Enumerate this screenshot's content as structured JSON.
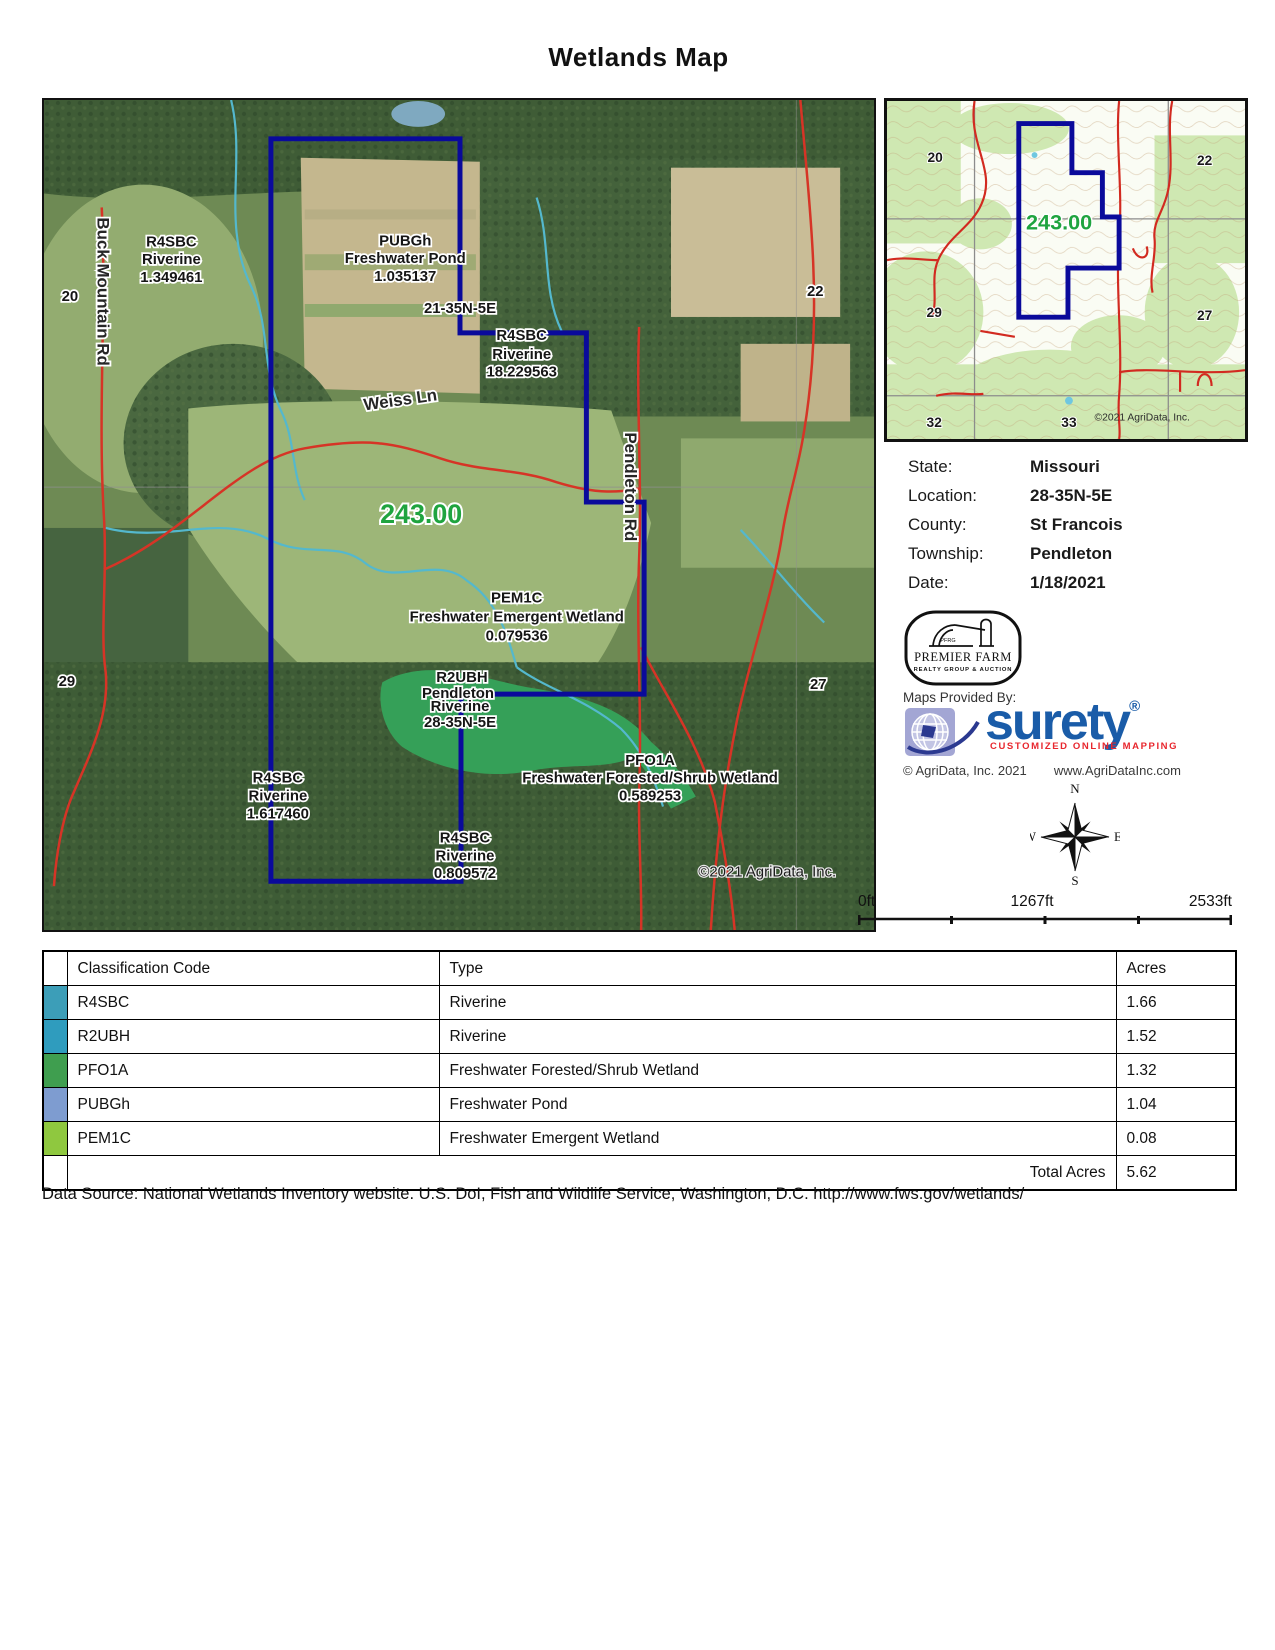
{
  "title": "Wetlands Map",
  "main_map": {
    "roads": {
      "buck_mountain": "Buck Mountain Rd",
      "weiss": "Weiss Ln",
      "pendleton": "Pendleton Rd"
    },
    "sections": {
      "s20": "20",
      "s21": "21-35N-5E",
      "s22": "22",
      "s29": "29",
      "s27": "27"
    },
    "parcel_acreage": "243.00",
    "wetlands": [
      {
        "code": "R4SBC",
        "type": "Riverine",
        "value": "1.349461"
      },
      {
        "code": "PUBGh",
        "type": "Freshwater Pond",
        "value": "1.035137"
      },
      {
        "code": "R4SBC",
        "type": "Riverine",
        "value": "18.229563"
      },
      {
        "code": "PEM1C",
        "type": "Freshwater Emergent Wetland",
        "value": "0.079536"
      },
      {
        "code": "PFO1A",
        "type": "Freshwater Forested/Shrub Wetland",
        "value": "0.589253"
      },
      {
        "code": "R4SBC",
        "type": "Riverine",
        "value": "1.617460"
      },
      {
        "code": "R4SBC",
        "type": "Riverine",
        "value": "0.809572"
      }
    ],
    "r2ubh_label": {
      "code": "R2UBH",
      "township": "Pendleton",
      "type": "Riverine",
      "section": "28-35N-5E"
    },
    "copyright": "©2021 AgriData, Inc."
  },
  "inset_map": {
    "sections": {
      "s20": "20",
      "s22": "22",
      "s29": "29",
      "s27": "27",
      "s32": "32",
      "s33": "33"
    },
    "parcel_acreage": "243.00",
    "copyright": "©2021 AgriData, Inc."
  },
  "info": {
    "rows": [
      {
        "label": "State:",
        "value": "Missouri"
      },
      {
        "label": "Location:",
        "value": "28-35N-5E"
      },
      {
        "label": "County:",
        "value": "St Francois"
      },
      {
        "label": "Township:",
        "value": "Pendleton"
      },
      {
        "label": "Date:",
        "value": "1/18/2021"
      }
    ]
  },
  "premier_farm_logo": {
    "abbr": "PFRG",
    "name": "PREMIER FARM",
    "tagline": "REALTY GROUP & AUCTION"
  },
  "maps_provided_by": "Maps Provided By:",
  "surety_logo": {
    "name": "surety",
    "registered": "®",
    "tagline": "CUSTOMIZED ONLINE MAPPING",
    "copyright": "© AgriData, Inc. 2021",
    "website": "www.AgriDataInc.com"
  },
  "compass": {
    "north": "N",
    "south": "S",
    "east": "E",
    "west": "W"
  },
  "scale_bar": {
    "start": "0ft",
    "middle": "1267ft",
    "end": "2533ft"
  },
  "table": {
    "headers": {
      "code": "Classification Code",
      "type": "Type",
      "acres": "Acres"
    },
    "rows": [
      {
        "color": "#3C9EB8",
        "code": "R4SBC",
        "type": "Riverine",
        "acres": "1.66"
      },
      {
        "color": "#2F9CBE",
        "code": "R2UBH",
        "type": "Riverine",
        "acres": "1.52"
      },
      {
        "color": "#3F9E4F",
        "code": "PFO1A",
        "type": "Freshwater Forested/Shrub Wetland",
        "acres": "1.32"
      },
      {
        "color": "#7E9CD0",
        "code": "PUBGh",
        "type": "Freshwater Pond",
        "acres": "1.04"
      },
      {
        "color": "#8FC83F",
        "code": "PEM1C",
        "type": "Freshwater Emergent Wetland",
        "acres": "0.08"
      }
    ],
    "total_label": "Total Acres",
    "total_value": "5.62"
  },
  "footer": "Data Source: National Wetlands Inventory website. U.S. DoI, Fish and Wildlife Service, Washington, D.C. http://www.fws.gov/wetlands/",
  "colors": {
    "boundary": "#0A0A9B",
    "acreage_label": "#1FA43F",
    "surety_blue": "#1A5CA8",
    "surety_red": "#E8262D"
  }
}
